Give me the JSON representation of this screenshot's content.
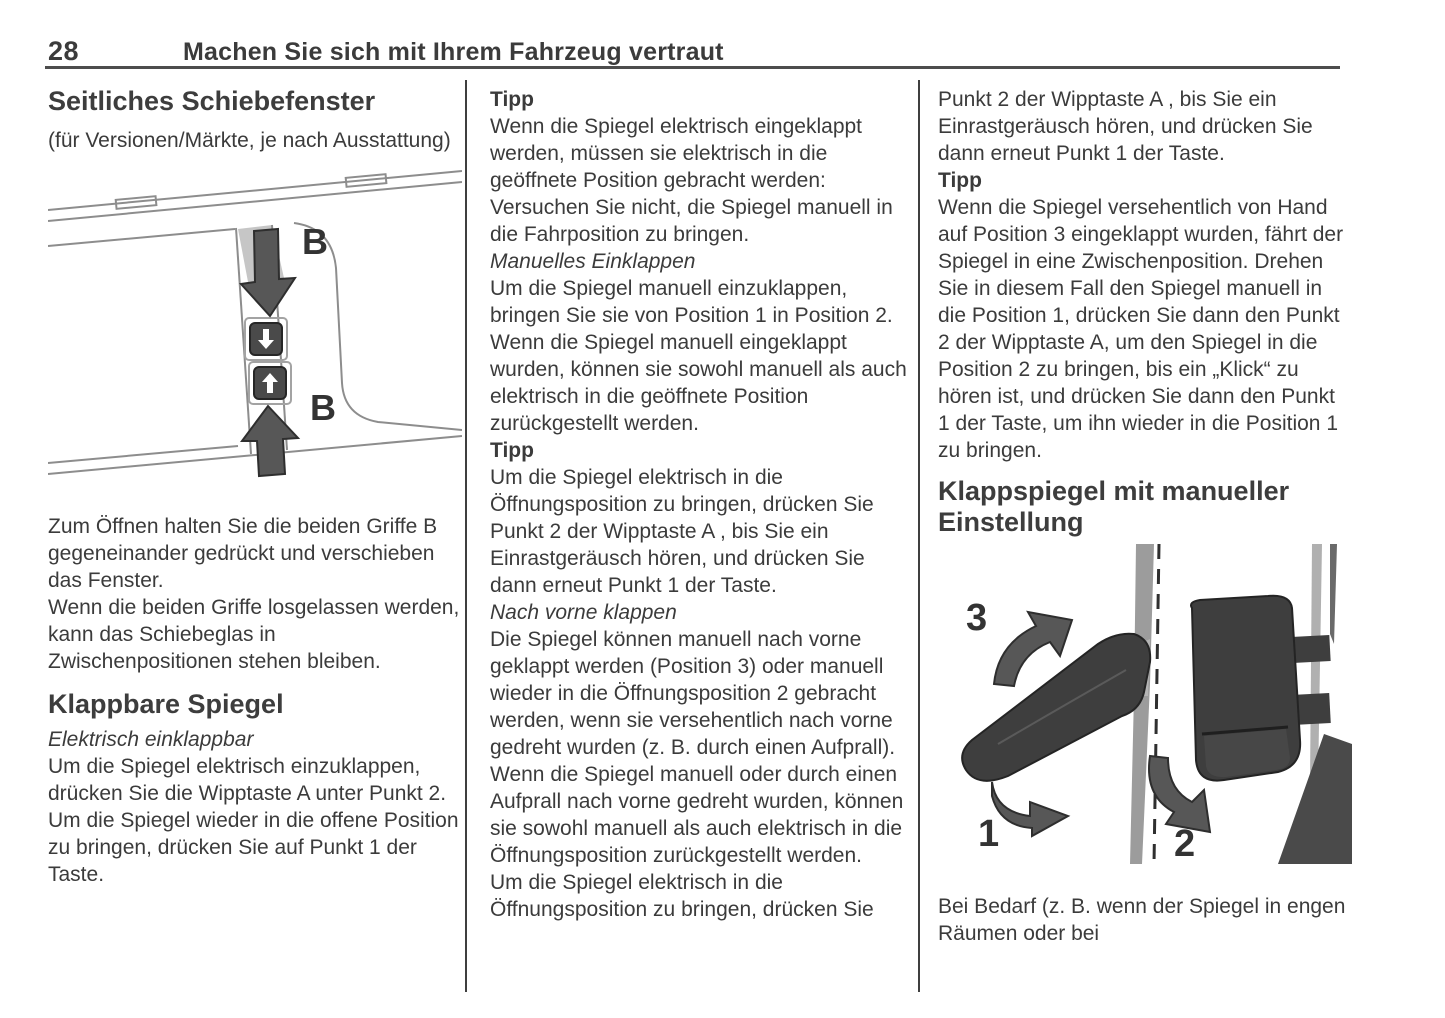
{
  "page": {
    "number": "28",
    "header_title": "Machen Sie sich mit Ihrem Fahrzeug vertraut"
  },
  "col1": {
    "heading1": "Seitliches Schiebefenster",
    "subnote": "(für Versionen/Märkte, je nach Ausstattung)",
    "para1": "Zum Öffnen halten Sie die beiden Griffe B gegeneinander gedrückt und verschieben das Fenster.",
    "para2": "Wenn die beiden Griffe losgelassen werden, kann das Schiebeglas in Zwischenpositionen stehen bleiben.",
    "heading2": "Klappbare Spiegel",
    "subhead_italic": "Elektrisch einklappbar",
    "para3": "Um die Spiegel elektrisch einzuklappen, drücken Sie die Wipptaste A unter Punkt 2. Um die Spiegel wieder in die offene Position zu bringen, drücken Sie auf Punkt 1 der Taste."
  },
  "col2": {
    "tip1_label": "Tipp",
    "tip1_text": "Wenn die Spiegel elektrisch eingeklappt werden, müssen sie elektrisch in die geöffnete Position gebracht werden: Versuchen Sie nicht, die Spiegel manuell in die Fahrposition zu bringen.",
    "subhead1": "Manuelles Einklappen",
    "para1": "Um die Spiegel manuell einzuklappen, bringen Sie sie von Position 1 in Position 2. Wenn die Spiegel manuell eingeklappt wurden, können sie sowohl manuell als auch elektrisch in die geöffnete Position zurückgestellt werden.",
    "tip2_label": "Tipp",
    "tip2_text": "Um die Spiegel elektrisch in die Öffnungsposition zu bringen, drücken Sie Punkt 2 der Wipptaste A , bis Sie ein Einrastgeräusch hören, und drücken Sie dann erneut Punkt 1 der Taste.",
    "subhead2": "Nach vorne klappen",
    "para2": "Die Spiegel können manuell nach vorne geklappt werden (Position 3) oder manuell wieder in die Öffnungsposition 2 gebracht werden, wenn sie versehentlich nach vorne gedreht wurden (z. B. durch einen Aufprall).",
    "para3": "Wenn die Spiegel manuell oder durch einen Aufprall nach vorne gedreht wurden, können sie sowohl manuell als auch elektrisch in die Öffnungsposition zurückgestellt werden.",
    "para4": "Um die Spiegel elektrisch in die Öffnungsposition zu bringen, drücken Sie"
  },
  "col3": {
    "para1": "Punkt 2 der Wipptaste A , bis Sie ein Einrastgeräusch hören, und drücken Sie dann erneut Punkt 1 der Taste.",
    "tip_label": "Tipp",
    "tip_text": "Wenn die Spiegel versehentlich von Hand auf Position 3 eingeklappt wurden, fährt der Spiegel in eine Zwischenposition. Drehen Sie in diesem Fall den Spiegel manuell in die Position 1, drücken Sie dann den Punkt 2 der Wipptaste A, um den Spiegel in die Position 2 zu bringen, bis ein „Klick“ zu hören ist, und drücken Sie dann den Punkt 1 der Taste, um ihn wieder in die Position 1 zu bringen.",
    "heading": "Klappspiegel mit manueller Einstellung",
    "para2": "Bei Bedarf (z. B. wenn der Spiegel in engen Räumen oder bei"
  },
  "figures": {
    "window": {
      "label_top": "B",
      "label_bottom": "B"
    },
    "mirrors": {
      "label_pos3": "3",
      "label_pos1": "1",
      "label_pos2": "2"
    }
  },
  "colors": {
    "text": "#3b3b3b",
    "rule": "#4d4d4d",
    "figure_dark": "#3e3e3e",
    "figure_gray": "#9c9c9c"
  }
}
